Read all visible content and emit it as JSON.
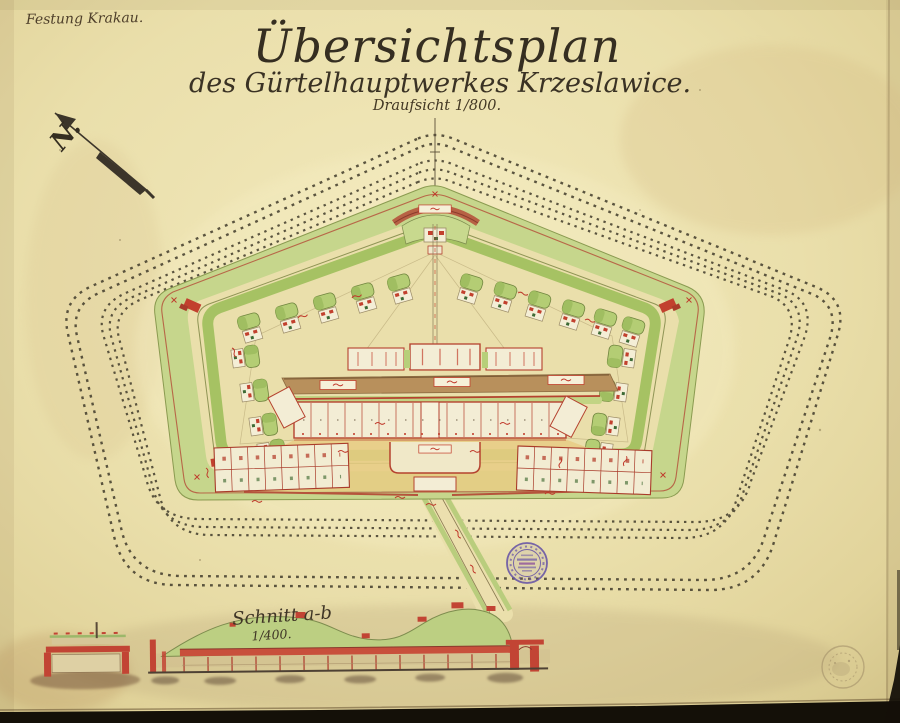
{
  "labels": {
    "archive_note": "Festung Krakau.",
    "title": "Übersichtsplan",
    "subtitle": "des Gürtelhauptwerkes Krzeslawice.",
    "view_scale": "Draufsicht 1/800.",
    "north": "N.",
    "section_title": "Schnitt a-b",
    "section_scale": "1/400."
  },
  "colors": {
    "paper": "#eadfab",
    "ink": "#3d3527",
    "masonry_red": "#c2402e",
    "crest_red_brown": "#b5543c",
    "glacis_green": "#c6d68c",
    "rampart_green": "#a6c263",
    "courtyard_tan": "#e8cc84",
    "road_brown": "#b8905c",
    "stamp_purple": "#6a57a6"
  }
}
